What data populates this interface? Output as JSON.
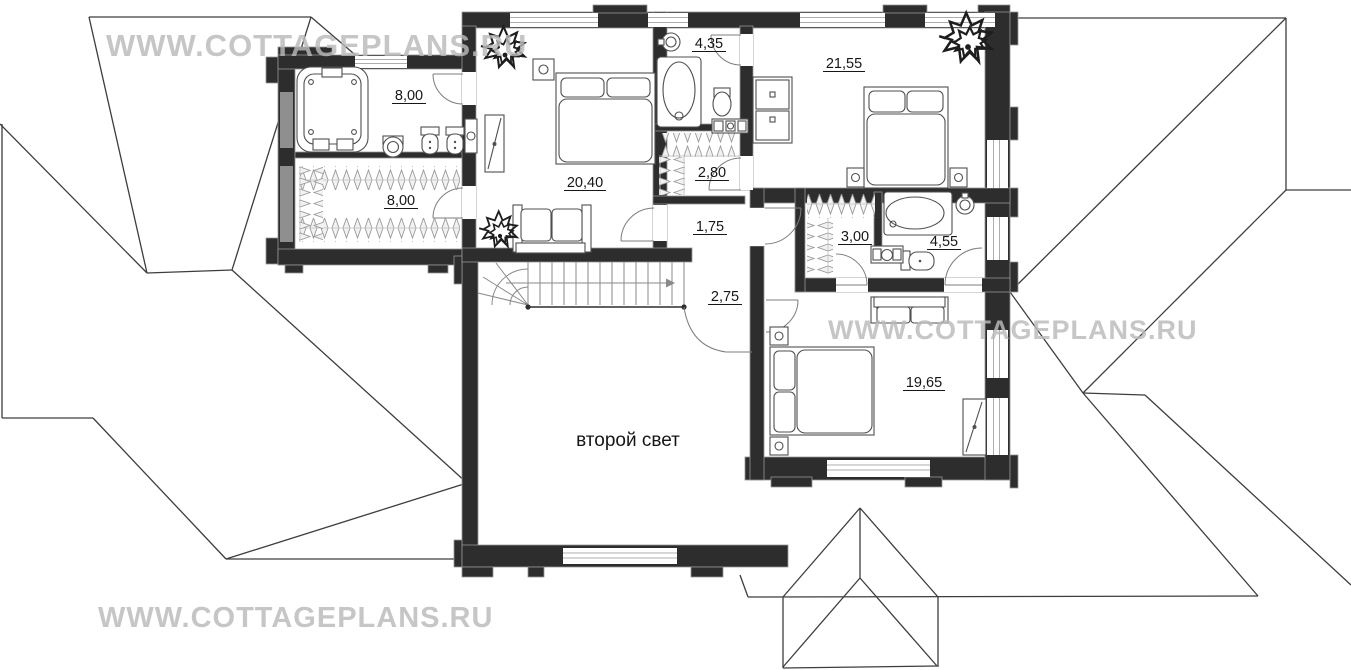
{
  "watermark": {
    "text": "WWW.COTTAGEPLANS.RU"
  },
  "plan": {
    "second_light_label": "второй свет",
    "rooms": [
      {
        "name": "bathroom-jacuzzi",
        "area": "8,00"
      },
      {
        "name": "wardrobe-left",
        "area": "8,00"
      },
      {
        "name": "bedroom-top-left",
        "area": "20,40"
      },
      {
        "name": "bathroom-top-middle",
        "area": "4,35"
      },
      {
        "name": "wardrobe-middle",
        "area": "2,80"
      },
      {
        "name": "hall-top",
        "area": "1,75"
      },
      {
        "name": "bedroom-top-right",
        "area": "21,55"
      },
      {
        "name": "wardrobe-right",
        "area": "3,00"
      },
      {
        "name": "bathroom-right",
        "area": "4,55"
      },
      {
        "name": "stair-landing",
        "area": "2,75"
      },
      {
        "name": "bedroom-bottom-right",
        "area": "19,65"
      }
    ],
    "colors": {
      "wall": "#2d2d2d",
      "furniture_line": "#4f4f4f",
      "roof_line": "#3d3d3d",
      "watermark": "#b9b9b9",
      "background": "#ffffff"
    }
  }
}
